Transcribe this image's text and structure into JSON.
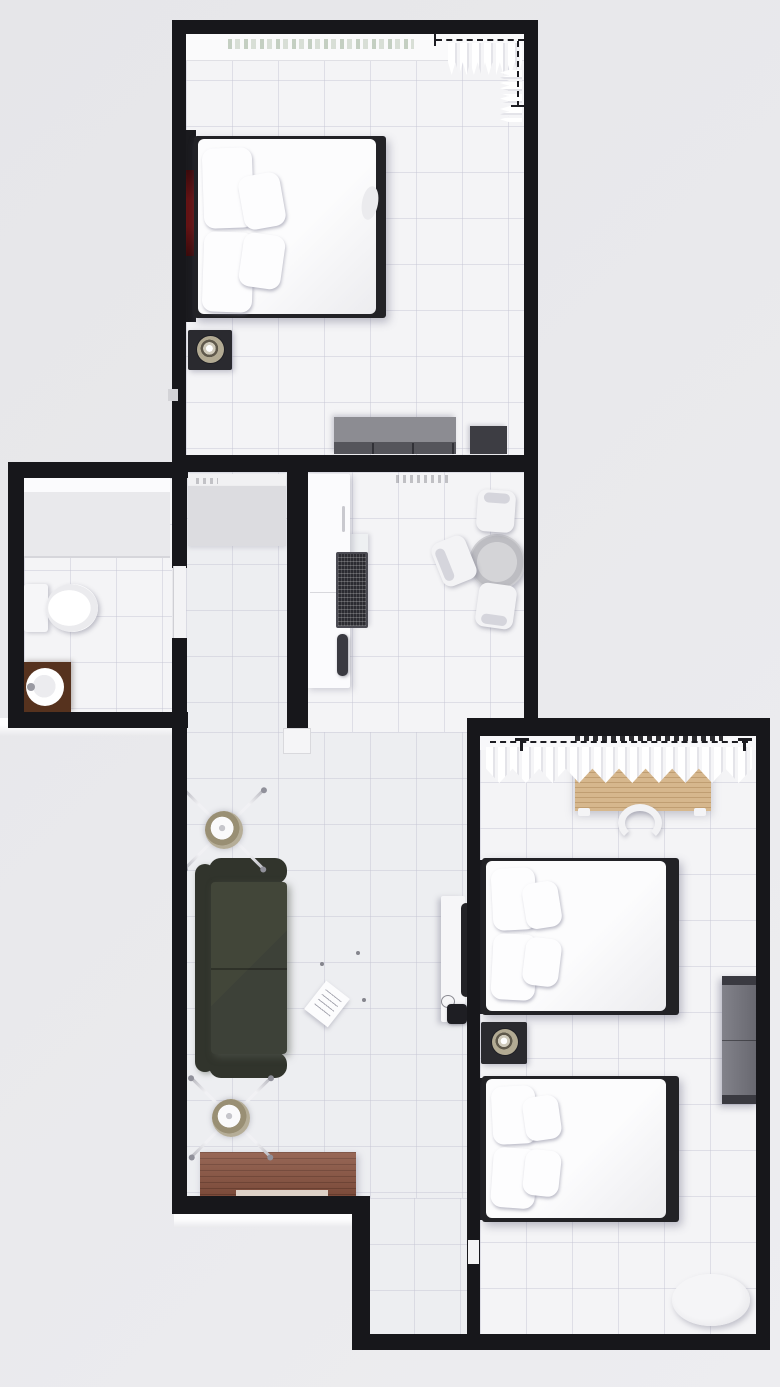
{
  "scene": {
    "kind": "3d-rendered-floor-plan-top-view",
    "units": "pixels",
    "width": 780,
    "height": 1387
  },
  "palette": {
    "background": "#e9e9ec",
    "wall": "#17171b",
    "floor_bed": "#f4f4f6",
    "floor_living": "#edeef1",
    "tile_line": "rgba(195,195,210,0.45)",
    "frame_dark": "#222226",
    "tv_red": "#641314",
    "nightstand": "#2a2a2f",
    "lamp_ring": "#b2aa93",
    "dresser": "#8c8c92",
    "dresser_dark": "#55555b",
    "cabinet": "#3d3d43",
    "counter": "#fbfbfd",
    "cooktop": "#2b2b31",
    "chair": "#f3f3f5",
    "vanity": "#56321e",
    "sofa": "#3d4138",
    "sofa_dark": "#31342c",
    "fan_hub": "#b5ad97",
    "desk_wood": "#d6b78d",
    "desk_grain": "#b99a6f",
    "wardrobe": "#75757b",
    "sideboard": "#8a5340",
    "curtain": "#ffffff",
    "curtain_shade": "#e4e4e9"
  },
  "rooms": [
    {
      "id": "bedroom-top",
      "furniture": [
        "double-bed",
        "four-pillows",
        "headboard",
        "wall-tv",
        "nightstand",
        "table-lamp",
        "dresser",
        "dark-cabinet",
        "window-sill",
        "curtain",
        "curtain-rod-dashed"
      ]
    },
    {
      "id": "kitchen",
      "furniture": [
        "counter",
        "cooktop",
        "faucet",
        "round-dining-table",
        "chair",
        "chair",
        "chair"
      ]
    },
    {
      "id": "bathroom",
      "furniture": [
        "shower",
        "toilet",
        "vanity",
        "round-sink",
        "door"
      ]
    },
    {
      "id": "hallway",
      "furniture": [
        "closet"
      ]
    },
    {
      "id": "living-room",
      "furniture": [
        "sofa",
        "ceiling-fan",
        "ceiling-fan",
        "tv-console",
        "edge-on-tv",
        "kettle",
        "floor-papers",
        "sideboard"
      ]
    },
    {
      "id": "bedroom-bottom",
      "furniture": [
        "desk",
        "desk-chair",
        "bed",
        "bed",
        "four-pillows",
        "nightstand",
        "table-lamp",
        "wardrobe",
        "pouf",
        "curtain",
        "curtain-rod-dashed",
        "window-hatches"
      ]
    }
  ]
}
